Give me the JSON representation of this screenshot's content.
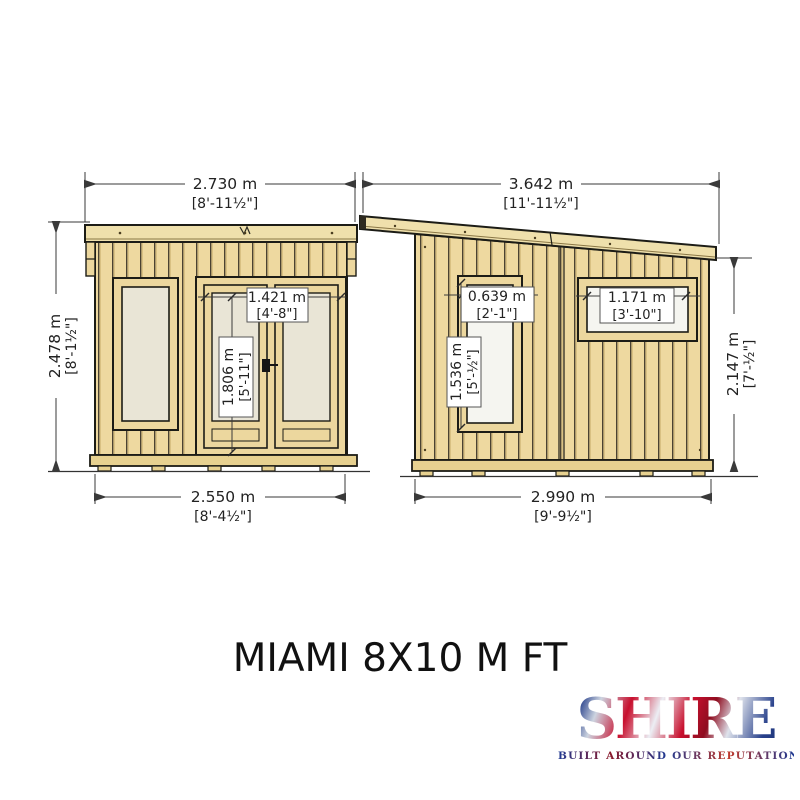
{
  "title": "MIAMI 8X10 M FT",
  "logo": {
    "name": "SHIRE",
    "tagline": "BUILT AROUND OUR REPUTATION"
  },
  "colors": {
    "wood": "#eed9a0",
    "wood_frame": "#ecd79e",
    "fascia": "#efe0ac",
    "glass_cream": "#e9e5d6",
    "glass_white": "#f5f5f0",
    "outline": "#1c1c16",
    "dimension": "#3a3a3a",
    "logo_navy": "#27408b",
    "logo_red": "#c8102e"
  },
  "dims": {
    "left_width": {
      "m": "2.730 m",
      "ft": "[8'-11½\"]"
    },
    "right_width": {
      "m": "3.642 m",
      "ft": "[11'-11½\"]"
    },
    "left_height": {
      "m": "2.478 m",
      "ft": "[8'-1½\"]"
    },
    "right_height": {
      "m": "2.147 m",
      "ft": "[7'-½\"]"
    },
    "left_base": {
      "m": "2.550 m",
      "ft": "[8'-4½\"]"
    },
    "right_base": {
      "m": "2.990 m",
      "ft": "[9'-9½\"]"
    },
    "door_width": {
      "m": "1.421 m",
      "ft": "[4'-8\"]"
    },
    "door_height": {
      "m": "1.806 m",
      "ft": "[5'-11\"]"
    },
    "side_window_width": {
      "m": "0.639 m",
      "ft": "[2'-1\"]"
    },
    "side_window_height": {
      "m": "1.536 m",
      "ft": "[5'-½\"]"
    },
    "rear_window_width": {
      "m": "1.171 m",
      "ft": "[3'-10\"]"
    }
  }
}
